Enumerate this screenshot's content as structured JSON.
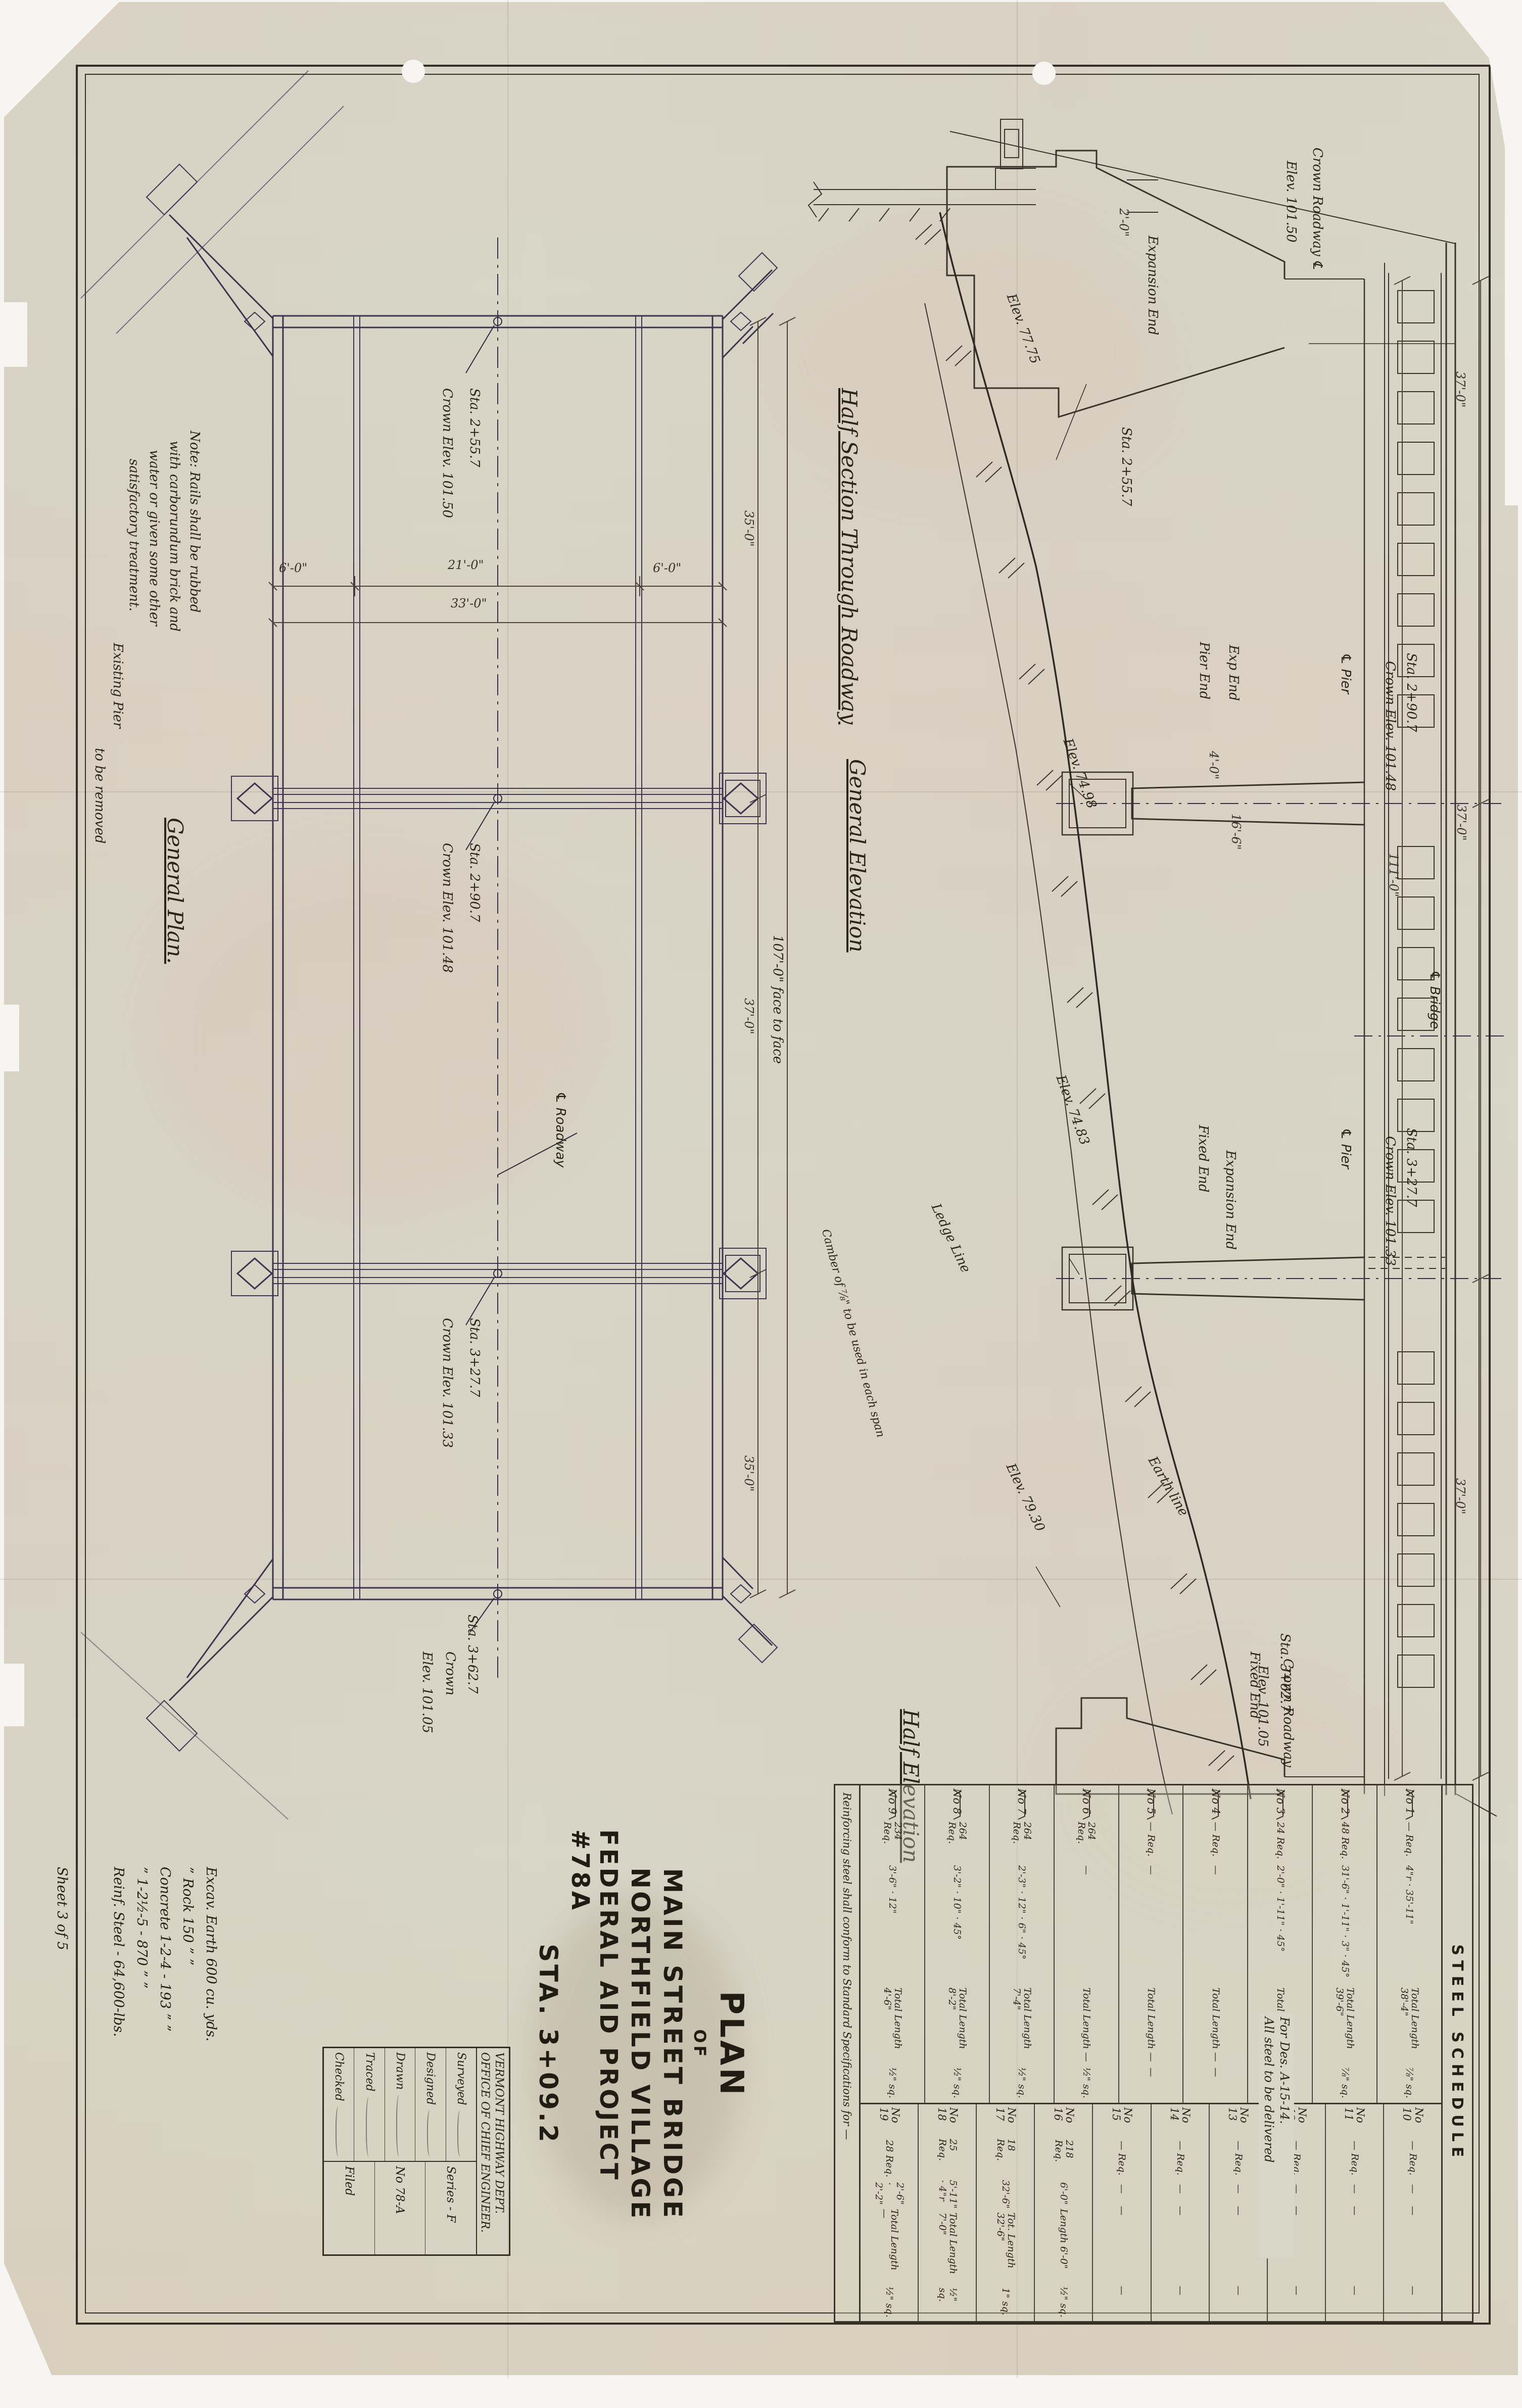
{
  "title_block": {
    "line1": "PLAN",
    "line2": "OF",
    "line3": "MAIN STREET BRIDGE",
    "line4": "NORTHFIELD VILLAGE",
    "line5": "FEDERAL AID PROJECT #78A",
    "line6": "STA. 3+09.2"
  },
  "agency_block": {
    "dept": "VERMONT HIGHWAY DEPT.",
    "office": "OFFICE OF CHIEF ENGINEER.",
    "rows": [
      {
        "label": "Surveyed"
      },
      {
        "label": "Designed"
      },
      {
        "label": "Drawn"
      },
      {
        "label": "Traced"
      },
      {
        "label": "Checked"
      }
    ],
    "series": "Series - F",
    "number": "No 78-A",
    "filed": "Filed"
  },
  "quantities": {
    "lines": [
      "Excav. Earth 600 cu. yds.",
      "” Rock 150 ” ”",
      "Concrete 1-2-4 - 193 ” ”",
      "” 1-2½-5 - 870 ” ”",
      "Reinf. Steel - 64,600-lbs."
    ],
    "sheet_note": "Sheet 3 of 5"
  },
  "plan": {
    "title": "General Plan.",
    "rails_note_l1": "Note: Rails shall be rubbed",
    "rails_note_l2": "with carborundum brick and",
    "rails_note_l3": "water or given some other",
    "rails_note_l4": "satisfactory treatment.",
    "pier_note_l1": "Existing Pier",
    "pier_note_l2": "to be removed",
    "cl_roadway": "℄ Roadway",
    "sta1": "Sta. 2+55.7",
    "crown1": "Crown Elev. 101.50",
    "sta2": "Sta. 2+90.7",
    "crown2": "Crown Elev. 101.48",
    "sta3": "Sta. 3+27.7",
    "crown3": "Crown Elev. 101.33",
    "sta4": "Sta. 3+62.7",
    "crown4": "Crown",
    "crown4b": "Elev. 101.05",
    "dim_curb_l": "6'-0\"",
    "dim_roadway": "21'-0\"",
    "dim_curb_r": "6'-0\"",
    "dim_width": "33'-0\"",
    "dim_span1": "35'-0\"",
    "dim_span2": "37'-0\"",
    "dim_span3": "35'-0\"",
    "dim_overall": "107'-0\" face to face",
    "camber_note": "Camber of ⅞\" to be used in each span"
  },
  "elevation": {
    "half_section": "Half Section Through Roadway",
    "title": "General Elevation",
    "half_elevation": "Half Elevation",
    "crown_top_l1": "Crown Roadway ℄",
    "crown_top_l2": "Elev. 101.50",
    "left_abutment_end": "Expansion End",
    "left_abutment_sta": "Sta. 2+55.7",
    "left_abutment_dim": "2'-0\"",
    "left_abutment_elev": "Elev. 77.75",
    "pier1_end_l": "Pier End",
    "pier1_end_r": "Exp End",
    "pier1_dim1": "4'-0\"",
    "pier1_dim2": "16'-6\"",
    "pier1_cl": "℄ Pier",
    "pier1_sta": "Sta. 2+90.7",
    "pier1_crown": "Crown Elev. 101.48",
    "pier1_footing_elev": "Elev. 74.98",
    "cl_bridge": "℄ Bridge",
    "dim_overall": "111'-0\"",
    "dim_span": "37'-0\"",
    "pier2_end_l": "Fixed End",
    "pier2_end_r": "Expansion End",
    "pier2_cl": "℄ Pier",
    "pier2_sta": "Sta. 3+27.7",
    "pier2_crown": "Crown Elev. 101.33",
    "pier2_footing_elev": "Elev. 74.83",
    "earth_line": "Earth line",
    "ledge_line": "Ledge Line",
    "right_abutment_elev": "Elev. 79.30",
    "right_abutment_sta": "Sta. 3+62.7",
    "right_abutment_end": "Fixed End",
    "crown_bottom_l1": "Crown Roadway",
    "crown_bottom_l2": "Elev. 101.05"
  },
  "schedule": {
    "title": "STEEL SCHEDULE",
    "rows_a": [
      {
        "no": "No 1",
        "req": "— Req.",
        "dims": "4\"r · 35'-11\"",
        "total": "Total Length 38'-4\"",
        "size": "⅞\" sq."
      },
      {
        "no": "No 2",
        "req": "48 Req.",
        "dims": "31'-6\" · 1'-11\" · 3\" · 45°",
        "total": "Total Length 39'-6\"",
        "size": "⅞\" sq."
      },
      {
        "no": "No 3",
        "req": "24 Req.",
        "dims": "2'-0\" · 1'-11\" · 45°",
        "total": "Total Length —",
        "size": "⅞\" sq."
      },
      {
        "no": "No 4",
        "req": "— Req.",
        "dims": "—",
        "total": "Total Length —",
        "size": "—"
      },
      {
        "no": "No 5",
        "req": "— Req.",
        "dims": "—",
        "total": "Total Length —",
        "size": "—"
      },
      {
        "no": "No 6",
        "req": "264 Req.",
        "dims": "—",
        "total": "Total Length —",
        "size": "½\" sq."
      },
      {
        "no": "No 7",
        "req": "264 Req.",
        "dims": "2'-3\" · 12\" · 6\" · 45°",
        "total": "Total Length 7'-4\"",
        "size": "½\" sq."
      },
      {
        "no": "No 8",
        "req": "264 Req.",
        "dims": "3'-2\" · 10\" · 45°",
        "total": "Total Length 8'-2\"",
        "size": "½\" sq."
      },
      {
        "no": "No 9",
        "req": "234 Req.",
        "dims": "3'-6\" · 12\"",
        "total": "Total Length 4'-6\"",
        "size": "½\" sq."
      }
    ],
    "rows_b": [
      {
        "no": "No 10",
        "req": "— Req.",
        "dims": "—",
        "total": "—",
        "size": "—"
      },
      {
        "no": "No 11",
        "req": "— Req.",
        "dims": "—",
        "total": "—",
        "size": "—"
      },
      {
        "no": "No 12",
        "req": "— Req.",
        "dims": "—",
        "total": "—",
        "size": "—"
      },
      {
        "no": "No 13",
        "req": "— Req.",
        "dims": "—",
        "total": "—",
        "size": "—"
      },
      {
        "no": "No 14",
        "req": "— Req.",
        "dims": "—",
        "total": "—",
        "size": "—"
      },
      {
        "no": "No 15",
        "req": "— Req.",
        "dims": "—",
        "total": "—",
        "size": "—"
      },
      {
        "no": "No 16",
        "req": "218 Req.",
        "dims": "6'-0\"",
        "total": "Length 6'-0\"",
        "size": "½\" sq."
      },
      {
        "no": "No 17",
        "req": "18 Req.",
        "dims": "32'-6\"",
        "total": "Tot. Length 32'-6\"",
        "size": "1\" sq."
      },
      {
        "no": "No 18",
        "req": "25 Req.",
        "dims": "5'-11\" · 4\"r",
        "total": "Total Length 7'-0\"",
        "size": "½\" sq."
      },
      {
        "no": "No 19",
        "req": "28 Req.",
        "dims": "2'-6\" · 2'-2\"",
        "total": "Total Length —",
        "size": "½\" sq."
      }
    ],
    "footer_note": "Reinforcing steel shall conform to Standard Specifications for —",
    "delivery_note_l1": "For Des. A-15-14.",
    "delivery_note_l2": "All steel to be delivered"
  }
}
